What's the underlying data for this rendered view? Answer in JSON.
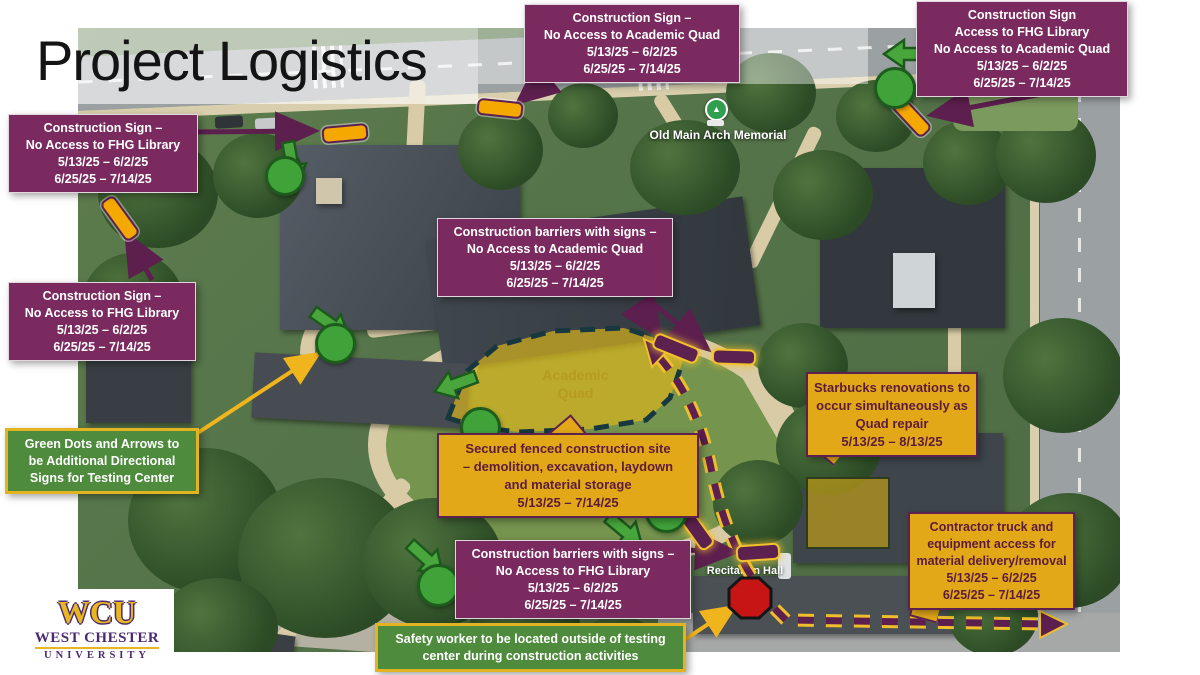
{
  "title": "Project Logistics",
  "map_labels": {
    "old_main": "Old Main Arch Memorial",
    "recitation": "Recitation Hall",
    "quad": [
      "Academic",
      "Quad"
    ],
    "watermark": [
      "West Chester",
      "University"
    ]
  },
  "logo": {
    "acronym": "WCU",
    "line1": "WEST CHESTER",
    "line2": "UNIVERSITY"
  },
  "callouts": [
    {
      "id": "sign-no-fhg-top",
      "style": "purple",
      "lines": [
        "Construction Sign –",
        "No Access to FHG Library",
        "5/13/25 – 6/2/25",
        "6/25/25 – 7/14/25"
      ]
    },
    {
      "id": "sign-no-academic-quad",
      "style": "purple",
      "lines": [
        "Construction Sign –",
        "No Access to Academic Quad",
        "5/13/25 – 6/2/25",
        "6/25/25 – 7/14/25"
      ]
    },
    {
      "id": "sign-access-fhg",
      "style": "purple",
      "lines": [
        "Construction Sign",
        "Access to FHG Library",
        "No Access to Academic Quad",
        "5/13/25 – 6/2/25",
        "6/25/25 – 7/14/25"
      ]
    },
    {
      "id": "sign-no-fhg-left",
      "style": "purple",
      "lines": [
        "Construction Sign –",
        "No Access to FHG Library",
        "5/13/25 – 6/2/25",
        "6/25/25 – 7/14/25"
      ]
    },
    {
      "id": "barriers-no-academic-quad",
      "style": "purple",
      "lines": [
        "Construction barriers with signs –",
        "No Access to Academic Quad",
        "5/13/25 – 6/2/25",
        "6/25/25 – 7/14/25"
      ]
    },
    {
      "id": "secured-site",
      "style": "gold",
      "lines": [
        "Secured fenced construction site",
        "– demolition, excavation, laydown",
        "and material storage",
        "5/13/25 – 7/14/25"
      ]
    },
    {
      "id": "starbucks",
      "style": "gold",
      "lines": [
        "Starbucks renovations to",
        "occur simultaneously as",
        "Quad repair",
        "5/13/25 – 8/13/25"
      ]
    },
    {
      "id": "contractor-access",
      "style": "gold",
      "lines": [
        "Contractor truck and",
        "equipment access for",
        "material delivery/removal",
        "5/13/25 – 6/2/25",
        "6/25/25 – 7/14/25"
      ]
    },
    {
      "id": "barriers-no-fhg",
      "style": "purple",
      "lines": [
        "Construction barriers with signs –",
        "No Access to FHG Library",
        "5/13/25 – 6/2/25",
        "6/25/25 – 7/14/25"
      ]
    },
    {
      "id": "green-dots-note",
      "style": "green",
      "lines": [
        "Green Dots and Arrows to",
        "be Additional Directional",
        "Signs for Testing Center"
      ]
    },
    {
      "id": "safety-worker",
      "style": "green",
      "lines": [
        "Safety worker to be located outside of testing",
        "center during construction activities"
      ]
    }
  ],
  "colors": {
    "callout_purple": "#7b2a60",
    "callout_gold": "#e2a818",
    "callout_green": "#4e8b3c",
    "arrow_purple": "#5d1f4e",
    "arrow_yellow": "#f0b41c",
    "dot_green": "#3fa33a",
    "stop_red": "#c71414",
    "sign_yellow": "#f5a800",
    "quad_overlay": "#d9b41e"
  }
}
